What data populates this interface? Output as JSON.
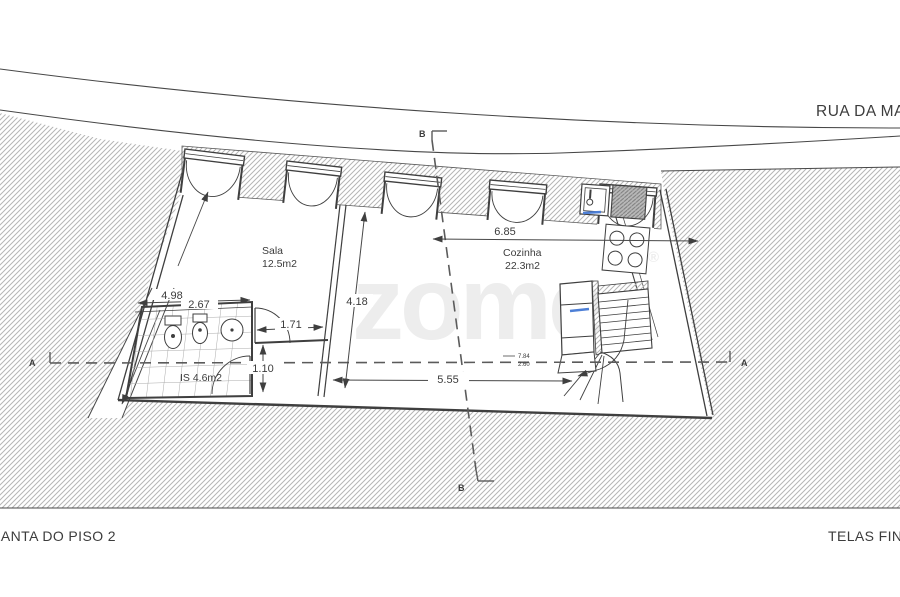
{
  "street_label": "RUA DA MADALENA",
  "titles": {
    "left": "PLANTA DO PISO 2",
    "right": "TELAS FINAIS"
  },
  "watermark": {
    "text": "zome",
    "mark": "®"
  },
  "rooms": {
    "sala": {
      "name": "Sala",
      "area": "12.5m2"
    },
    "cozinha": {
      "name": "Cozinha",
      "area": "22.3m2"
    },
    "is": {
      "label": "IS 4.6m2"
    }
  },
  "dimensions": {
    "kitchen_width": "6.85",
    "sala_depth": "4.18",
    "hall_width": "5.55",
    "bath_outer": "4.98",
    "bath_inner": "2.67",
    "door_width": "1.71",
    "bath_depth": "1.10"
  },
  "levels": {
    "upper": "7.84",
    "lower": "2.60"
  },
  "sections": {
    "a_left": "A",
    "a_right": "A",
    "b_top": "B",
    "b_bottom": "B"
  },
  "colors": {
    "line": "#3f3f3f",
    "hatch": "#b5b5b5",
    "accent_blue": "#4d7fd6",
    "watermark": "#ededed"
  }
}
